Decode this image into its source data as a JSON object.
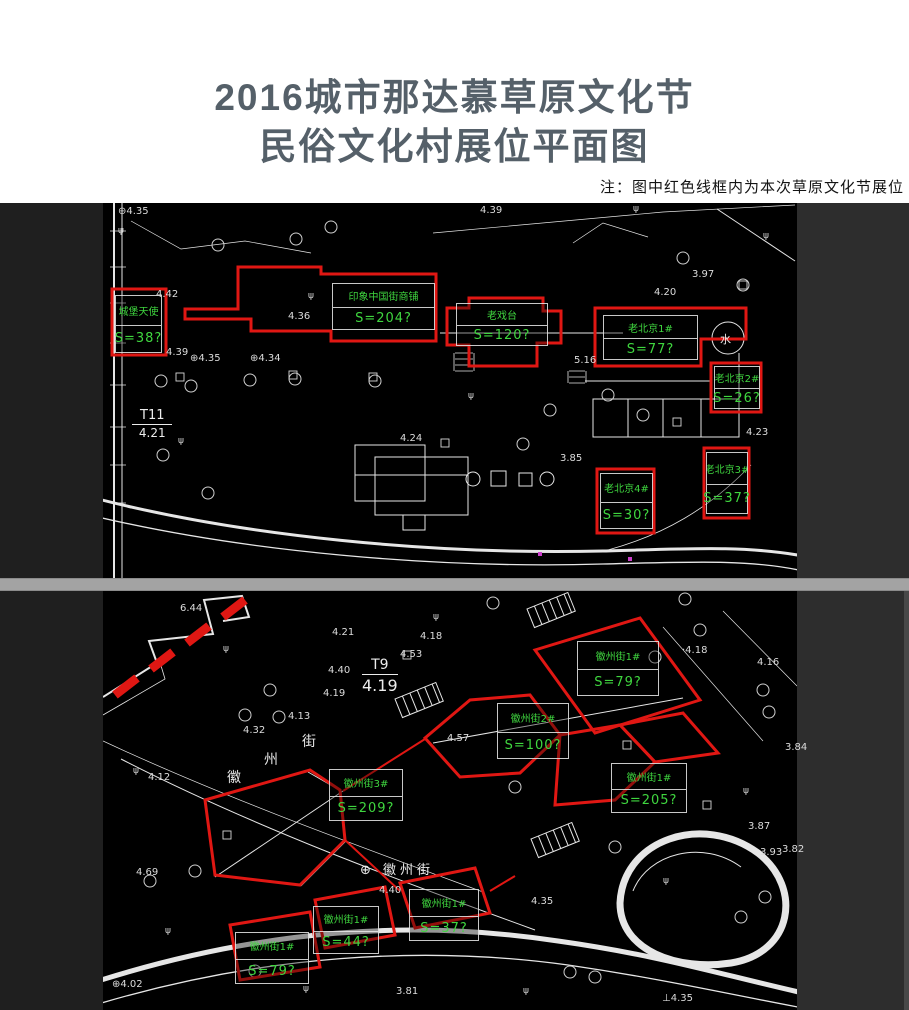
{
  "header": {
    "title_line1": "2016城市那达慕草原文化节",
    "title_line2": "民俗文化村展位平面图",
    "note": "注：图中红色线框内为本次草原文化节展位"
  },
  "colors": {
    "booth_red": "#e01713",
    "label_green": "#3fd63f",
    "title_gray": "#556069",
    "divider_gray": "#a3a3a3"
  },
  "upper_plan": {
    "station": {
      "name": "T11",
      "elevation": "4.21"
    },
    "water_label": "水",
    "booths": [
      {
        "name": "城堡天使",
        "area": "S=38?",
        "x": 115,
        "y": 92,
        "w": 47,
        "h": 58
      },
      {
        "name": "印象中国街商铺",
        "area": "S=204?",
        "x": 332,
        "y": 80,
        "w": 103,
        "h": 47
      },
      {
        "name": "老戏台",
        "area": "S=120?",
        "x": 456,
        "y": 100,
        "w": 92,
        "h": 43
      },
      {
        "name": "老北京1#",
        "area": "S=77?",
        "x": 603,
        "y": 112,
        "w": 95,
        "h": 45
      },
      {
        "name": "老北京2#",
        "area": "S=26?",
        "x": 714,
        "y": 163,
        "w": 46,
        "h": 43
      },
      {
        "name": "老北京3#",
        "area": "S=37?",
        "x": 706,
        "y": 249,
        "w": 42,
        "h": 62
      },
      {
        "name": "老北京4#",
        "area": "S=30?",
        "x": 600,
        "y": 270,
        "w": 53,
        "h": 56
      }
    ],
    "elevations": [
      {
        "t": "⊕4.35",
        "x": 118,
        "y": 3
      },
      {
        "t": "4.39",
        "x": 480,
        "y": 2
      },
      {
        "t": "4.42",
        "x": 156,
        "y": 86
      },
      {
        "t": "4.36",
        "x": 288,
        "y": 108
      },
      {
        "t": "3.97",
        "x": 692,
        "y": 66
      },
      {
        "t": "4.20",
        "x": 654,
        "y": 84
      },
      {
        "t": "4.39",
        "x": 166,
        "y": 144
      },
      {
        "t": "⊕4.35",
        "x": 190,
        "y": 150
      },
      {
        "t": "⊕4.34",
        "x": 250,
        "y": 150
      },
      {
        "t": "4.24",
        "x": 400,
        "y": 230
      },
      {
        "t": "3.85",
        "x": 560,
        "y": 250
      },
      {
        "t": "4.23",
        "x": 746,
        "y": 224
      },
      {
        "t": "5.16",
        "x": 574,
        "y": 152
      }
    ]
  },
  "lower_plan": {
    "station": {
      "name": "T9",
      "elevation": "4.19"
    },
    "street_label": "⊕ 徽州街",
    "street_vertical": [
      "街",
      "州",
      "徽"
    ],
    "booths": [
      {
        "name": "徽州街1#",
        "area": "S=79?",
        "x": 577,
        "y": 50,
        "w": 82,
        "h": 55
      },
      {
        "name": "徽州街2#",
        "area": "S=100?",
        "x": 497,
        "y": 112,
        "w": 72,
        "h": 56
      },
      {
        "name": "徽州街3#",
        "area": "S=209?",
        "x": 329,
        "y": 178,
        "w": 74,
        "h": 52
      },
      {
        "name": "徽州街1#",
        "area": "S=205?",
        "x": 611,
        "y": 172,
        "w": 76,
        "h": 50
      },
      {
        "name": "徽州街1#",
        "area": "S=37?",
        "x": 409,
        "y": 298,
        "w": 70,
        "h": 52
      },
      {
        "name": "徽州街1#",
        "area": "S=44?",
        "x": 313,
        "y": 315,
        "w": 66,
        "h": 48
      },
      {
        "name": "徽州街1#",
        "area": "S=79?",
        "x": 235,
        "y": 341,
        "w": 74,
        "h": 52
      }
    ],
    "elevations": [
      {
        "t": "6.44",
        "x": 180,
        "y": 12
      },
      {
        "t": "4.21",
        "x": 332,
        "y": 36
      },
      {
        "t": "4.18",
        "x": 420,
        "y": 40
      },
      {
        "t": "4.53",
        "x": 400,
        "y": 58
      },
      {
        "t": "·4.18",
        "x": 682,
        "y": 54
      },
      {
        "t": "4.16",
        "x": 757,
        "y": 66
      },
      {
        "t": "4.40",
        "x": 328,
        "y": 74
      },
      {
        "t": "4.19",
        "x": 323,
        "y": 97
      },
      {
        "t": "4.13",
        "x": 288,
        "y": 120
      },
      {
        "t": "4.32",
        "x": 243,
        "y": 134
      },
      {
        "t": "4.57",
        "x": 447,
        "y": 142
      },
      {
        "t": "4.12",
        "x": 148,
        "y": 181
      },
      {
        "t": "3.84",
        "x": 785,
        "y": 151
      },
      {
        "t": "3.87",
        "x": 748,
        "y": 230
      },
      {
        "t": "3.93",
        "x": 760,
        "y": 256
      },
      {
        "t": "3.82",
        "x": 782,
        "y": 253
      },
      {
        "t": "4.69",
        "x": 136,
        "y": 276
      },
      {
        "t": "4.40",
        "x": 379,
        "y": 294
      },
      {
        "t": "4.35",
        "x": 531,
        "y": 305
      },
      {
        "t": "⊕4.02",
        "x": 112,
        "y": 388
      },
      {
        "t": "3.81",
        "x": 396,
        "y": 395
      },
      {
        "t": "⊥4.35",
        "x": 662,
        "y": 402
      }
    ]
  }
}
